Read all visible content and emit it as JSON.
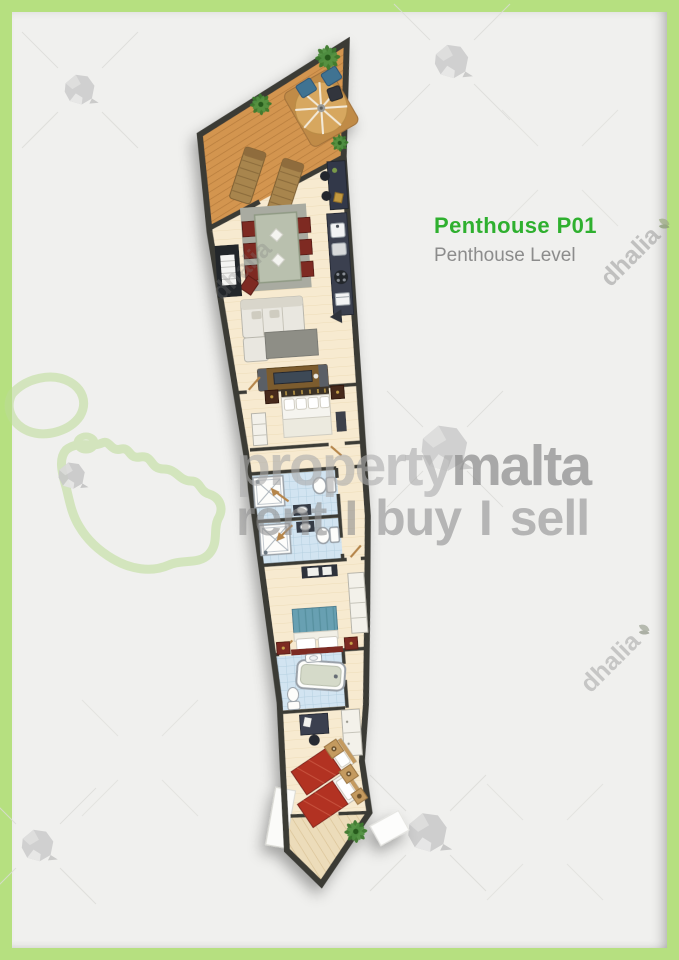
{
  "header": {
    "title": "Penthouse P01",
    "subtitle": "Penthouse Level"
  },
  "watermarks": {
    "brand_prefix": "property",
    "brand_suffix": "malta",
    "tagline": "rent I buy I sell",
    "agency": "dhalia"
  },
  "colors": {
    "frame_green": "#b6e080",
    "background": "#f0f0ee",
    "title_green": "#2fb02f",
    "subtitle_gray": "#8c8c8c",
    "watermark_gray": "#929292",
    "wall": "#3a3a36",
    "deck_wood": "#d39550",
    "interior_floor": "#f7ead0",
    "bathroom_tile": "#d2e4f1",
    "bed_red": "#b23324",
    "bed_teal": "#68a0b2",
    "dining_chair_red": "#7e2a22",
    "malta_outline_green": "#bcdc96"
  },
  "floor_plan": {
    "unit": "Penthouse P01",
    "level": "Penthouse Level",
    "rooms": [
      {
        "name": "roof-terrace",
        "furniture": [
          "wood-deck",
          "sun-lounger",
          "sun-lounger",
          "parasol-dining-set",
          "outdoor-chair",
          "outdoor-chair",
          "side-table",
          "palm-plant",
          "palm-plant",
          "palm-plant"
        ]
      },
      {
        "name": "entrance-hall",
        "furniture": [
          "console-desk",
          "stool",
          "stool"
        ]
      },
      {
        "name": "kitchen",
        "furniture": [
          "counter",
          "sink",
          "dishwasher",
          "hob",
          "oven"
        ]
      },
      {
        "name": "dining-area",
        "furniture": [
          "dining-table",
          "chair",
          "chair",
          "chair",
          "chair",
          "chair",
          "chair",
          "chair",
          "rug",
          "stairwell"
        ]
      },
      {
        "name": "living-area",
        "furniture": [
          "corner-sofa",
          "rug",
          "tv-unit",
          "entrance-arrow"
        ]
      },
      {
        "name": "bedroom-1",
        "furniture": [
          "double-bed",
          "nightstand",
          "nightstand",
          "wardrobe",
          "bench"
        ]
      },
      {
        "name": "hallway",
        "furniture": []
      },
      {
        "name": "bathroom-1",
        "furniture": [
          "shower",
          "toilet",
          "washbasin"
        ]
      },
      {
        "name": "bathroom-2",
        "furniture": [
          "shower",
          "toilet",
          "washbasin"
        ]
      },
      {
        "name": "bedroom-2",
        "furniture": [
          "double-bed",
          "nightstand",
          "nightstand",
          "dresser",
          "wardrobe"
        ]
      },
      {
        "name": "bathroom-3",
        "furniture": [
          "bathtub",
          "toilet",
          "washbasin"
        ]
      },
      {
        "name": "bedroom-3",
        "furniture": [
          "single-bed",
          "single-bed",
          "nightstand",
          "nightstand",
          "nightstand",
          "desk",
          "wardrobe"
        ]
      },
      {
        "name": "balcony",
        "furniture": [
          "palm-plant"
        ]
      }
    ]
  }
}
